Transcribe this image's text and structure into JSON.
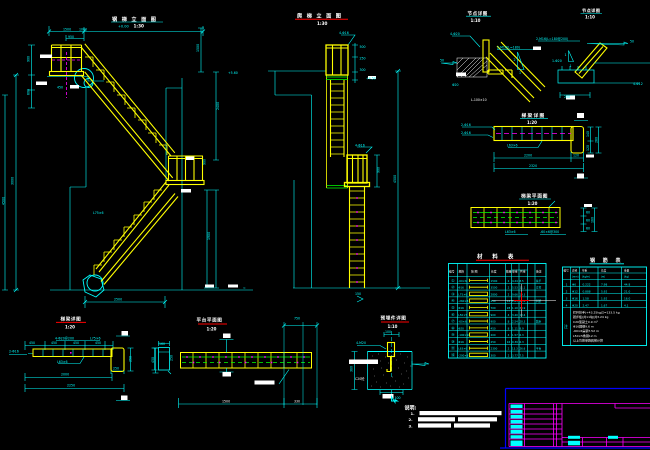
{
  "drawing": {
    "type": "CAD steel stair / ladder detail sheet",
    "background": "#000000",
    "accent_colors": {
      "structure": "#ffff00",
      "dims": "#00ffff",
      "grating": "#00ff00",
      "axis": "#ff00ff",
      "titleblock_frame": "#ff00ff",
      "titleblock_border": "#0000ff",
      "underline_red": "#ff0000",
      "underline_cyan": "#00ffff"
    }
  },
  "titles": {
    "stair": {
      "label": "钢梯立面图",
      "scale": "1:30",
      "level": "+0.00"
    },
    "ladder": {
      "label": "爬梯立面图",
      "scale": "1:30"
    },
    "detail_a": {
      "label": "节点详图",
      "scale": "1:10"
    },
    "detail_b": {
      "label": "节点详图",
      "scale": "1:10"
    },
    "beam_elev": {
      "label": "梯梁详图",
      "scale": "1:20"
    },
    "beam_plan": {
      "label": "梯梁平面图",
      "scale": "1:20"
    },
    "bl_beam": {
      "label": "梯梁详图",
      "scale": "1:20"
    },
    "bl_plan": {
      "label": "平台平面图",
      "scale": "1:20"
    },
    "foundation": {
      "label": "预埋件详图",
      "scale": "1:10"
    },
    "material_table": {
      "label": "材 料 表"
    },
    "rebar_table": {
      "label": "钢 筋 表"
    }
  },
  "annotations": [
    [
      "1500",
      63,
      30.5
    ],
    [
      "1060",
      79,
      30.5
    ],
    [
      "950",
      68,
      37.8
    ],
    [
      "450",
      57,
      88.5
    ],
    [
      "L75×6",
      93,
      214
    ],
    [
      "2500",
      114,
      300.5
    ],
    [
      "≈",
      243,
      289
    ],
    [
      "+5.60",
      228,
      74
    ],
    [
      "3000",
      13.5,
      185,
      "c",
      -90
    ],
    [
      "900",
      29.5,
      62,
      "c",
      -90
    ],
    [
      "600",
      29.5,
      95,
      "c",
      -90
    ],
    [
      "4500",
      4.5,
      205,
      "c",
      -90
    ],
    [
      "1500",
      199,
      52,
      "c",
      -90
    ],
    [
      "2400",
      219,
      110,
      "c",
      -90
    ],
    [
      "1900",
      210,
      240,
      "c",
      -90
    ],
    [
      "900",
      205.5,
      165,
      "c",
      -90
    ],
    [
      "4-Φ16",
      339,
      34
    ],
    [
      "500",
      359.5,
      48
    ],
    [
      "250",
      359.5,
      59.5
    ],
    [
      "300",
      359.5,
      71
    ],
    [
      "+4.50",
      366,
      79.5
    ],
    [
      "4-Φ16",
      355,
      146.5
    ],
    [
      "150",
      355,
      295
    ],
    [
      "900",
      379.5,
      173,
      "c",
      -90
    ],
    [
      "4500",
      396,
      183,
      "c",
      -90
    ],
    [
      "4-Φ20",
      450,
      35
    ],
    [
      "2-M16(L=180)",
      497,
      48.5
    ],
    [
      "50",
      440,
      61.5
    ],
    [
      "2",
      513.5,
      61
    ],
    [
      "1",
      519,
      74
    ],
    [
      "L-100×10",
      471,
      101,
      "w"
    ],
    [
      "Φ20",
      452,
      86
    ],
    [
      "2-M16(L=180@200)",
      536,
      40
    ],
    [
      "1-Φ20",
      552,
      62
    ],
    [
      "1",
      564.5,
      56
    ],
    [
      "1",
      569.5,
      67
    ],
    [
      "50",
      630,
      42.5
    ],
    [
      "4-Φ12",
      633,
      85
    ],
    [
      "250",
      564,
      98
    ],
    [
      "2-Φ16",
      461,
      126
    ],
    [
      "2-Φ16",
      461,
      134
    ],
    [
      "L63×6",
      507,
      146.5
    ],
    [
      "2200",
      524,
      156.5
    ],
    [
      "120",
      573,
      156.5
    ],
    [
      "2320",
      529,
      167
    ],
    [
      "140",
      589,
      137,
      "c",
      -90
    ],
    [
      "120",
      589,
      151,
      "c",
      -90
    ],
    [
      "260",
      597.5,
      143,
      "c",
      -90
    ],
    [
      "L63×6",
      505,
      233
    ],
    [
      "-60×6@300",
      540,
      233
    ],
    [
      "60",
      586,
      213.5
    ],
    [
      "60",
      586,
      221.5
    ],
    [
      "60",
      586,
      229.5
    ],
    [
      "180",
      593.5,
      223,
      "c",
      -90
    ],
    [
      "4-Φ20@200",
      55,
      339.5
    ],
    [
      "L75×6",
      90,
      339.5
    ],
    [
      "450",
      29,
      343.8
    ],
    [
      "450",
      51,
      343.8
    ],
    [
      "450",
      73,
      343.8
    ],
    [
      "450",
      95,
      343.8
    ],
    [
      "2-Φ16",
      9,
      352.5
    ],
    [
      "L63×6",
      57,
      362.8
    ],
    [
      "250",
      113,
      369.5
    ],
    [
      "2000",
      61,
      375.5
    ],
    [
      "2250",
      67,
      386.5
    ],
    [
      "160",
      159,
      345
    ],
    [
      "250",
      131.5,
      362,
      "c",
      -90
    ],
    [
      "250",
      172.5,
      361,
      "c",
      -90
    ],
    [
      "450",
      154,
      363,
      "c",
      -90
    ],
    [
      "750",
      294,
      319.5
    ],
    [
      "1500",
      222,
      402.5,
      "w"
    ],
    [
      "330",
      294,
      402.5,
      "w"
    ],
    [
      "4-M20",
      356,
      344
    ],
    [
      "100",
      385,
      333
    ],
    [
      "C20砼",
      355,
      380,
      "w"
    ],
    [
      "100",
      394.5,
      399
    ],
    [
      "380",
      352.5,
      372,
      "c",
      -90
    ]
  ],
  "material_table": {
    "headers": [
      "编号",
      "规格",
      "简  图",
      "长度",
      "数量",
      "单重",
      "共重",
      "备注"
    ],
    "rows": [
      {
        "n": "①",
        "spec": "-60×6",
        "len": "1500",
        "qty": "2",
        "uw": "4.24",
        "tw": "8.5",
        "note": "扶手",
        "box": false
      },
      {
        "n": "②",
        "spec": "Φ16",
        "len": "3500",
        "qty": "2",
        "uw": "5.53",
        "tw": "11.1",
        "note": "立柱",
        "box": false
      },
      {
        "n": "③",
        "spec": "L75×6",
        "len": "2800",
        "qty": "2",
        "uw": "9.66",
        "tw": "19.3",
        "note": "",
        "box": true
      },
      {
        "n": "④",
        "spec": "-260×8",
        "len": "250",
        "qty": "14",
        "uw": "1.63",
        "tw": "22.8",
        "note": "斜梁",
        "box": true
      },
      {
        "n": "⑤",
        "spec": "Φ16",
        "len": "700",
        "qty": "28",
        "uw": "1.10",
        "tw": "30.9",
        "note": "",
        "box": false
      },
      {
        "n": "⑥",
        "spec": "L50×5",
        "len": "900",
        "qty": "4",
        "uw": "3.40",
        "tw": "13.6",
        "note": "",
        "box": true
      },
      {
        "n": "⑦",
        "spec": "-60×6",
        "len": "900",
        "qty": "8",
        "uw": "2.54",
        "tw": "20.3",
        "note": "踏步",
        "box": false
      },
      {
        "n": "⑧",
        "spec": "Φ20",
        "len": "450",
        "qty": "8",
        "uw": "1.11",
        "tw": "8.9",
        "note": "",
        "box": false
      },
      {
        "n": "⑨",
        "spec": "-100×10",
        "len": "200",
        "qty": "4",
        "uw": "1.57",
        "tw": "6.3",
        "note": "",
        "box": true
      },
      {
        "n": "⑩",
        "spec": "Φ16",
        "len": "250",
        "qty": "16",
        "uw": "0.39",
        "tw": "6.3",
        "note": "",
        "box": false
      },
      {
        "n": "⑪",
        "spec": "L63×6",
        "len": "2300",
        "qty": "2",
        "uw": "13.3",
        "tw": "26.6",
        "note": "平台",
        "box": false
      },
      {
        "n": "⑫",
        "spec": "-200×8",
        "len": "300",
        "qty": "2",
        "uw": "3.77",
        "tw": "7.5",
        "note": "",
        "box": true
      }
    ]
  },
  "rebar_table": {
    "headers": [
      "编号",
      "直径",
      "单重",
      "长度",
      "重量"
    ],
    "units": [
      "",
      "(mm)",
      "(kg/m)",
      "(m)",
      "(kg)"
    ],
    "rows": [
      [
        "1",
        "Φ6",
        "0.222",
        "7.98",
        "44.8"
      ],
      [
        "2",
        "Φ12",
        "0.888",
        "5.92",
        "21.0"
      ],
      [
        "3",
        "Φ16",
        "1.58",
        "1.92",
        "16.0"
      ],
      [
        "4",
        "Φ20",
        "2.47",
        "1.67",
        "4.1"
      ]
    ],
    "note_label": "注",
    "notes": [
      "栏杆扶手(+43.25kg)Σ=133.5 kg",
      "踏步板(共11块)共3.24 kg",
      "C20混凝土0.9 m³",
      "Φ16圆钢9.6 m",
      "-60×6扁钢7.52 m",
      "L50×5角钢12 m",
      "以上均按单跑爬梯计算"
    ]
  },
  "notes": {
    "header": "说明:",
    "items": [
      {
        "num": "1."
      },
      {
        "num": "2."
      },
      {
        "num": "3."
      }
    ]
  }
}
